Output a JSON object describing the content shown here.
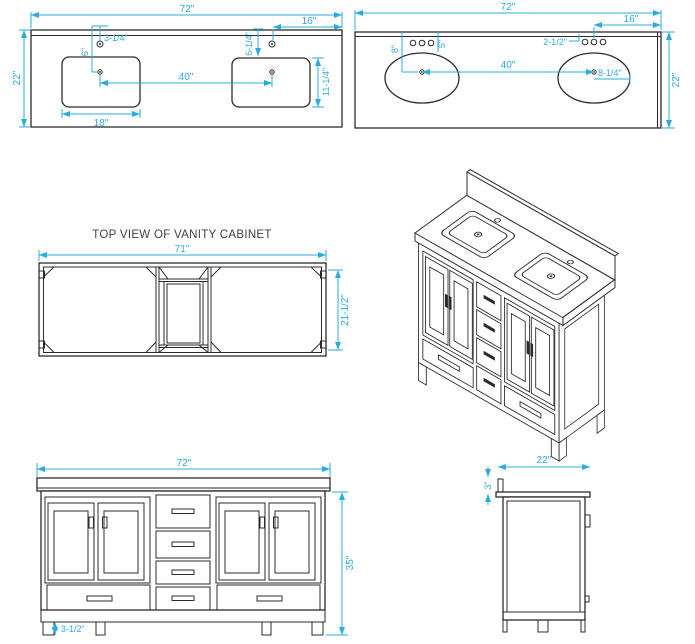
{
  "colors": {
    "dimension": "#29abe2",
    "line": "#2b2b2b",
    "text": "#404040"
  },
  "counter_rect": {
    "width": "72\"",
    "depth": "22\"",
    "right_offset": "16\"",
    "hole_setback": "3-1/4\"",
    "hole_to_center": "6\"",
    "right_hole_to_rim": "6-1/4\"",
    "sink_depth": "11-1/4\"",
    "center_to_center": "40\"",
    "sink_width": "18\""
  },
  "counter_oval": {
    "width": "72\"",
    "right_offset": "16\"",
    "hole_spacing": "2-1/2\"",
    "left_setback": "8\"",
    "hole_to_center": "5\"",
    "center_to_center": "40\"",
    "center_to_edge": "8-1/4\"",
    "depth": "22\""
  },
  "cabinet_top": {
    "title": "TOP VIEW OF VANITY CABINET",
    "width": "71\"",
    "depth": "21-1/2\""
  },
  "front": {
    "width": "72\"",
    "height": "35\"",
    "toe_kick": "3-1/2\""
  },
  "side": {
    "depth": "22\"",
    "backsplash_height": "3\""
  }
}
